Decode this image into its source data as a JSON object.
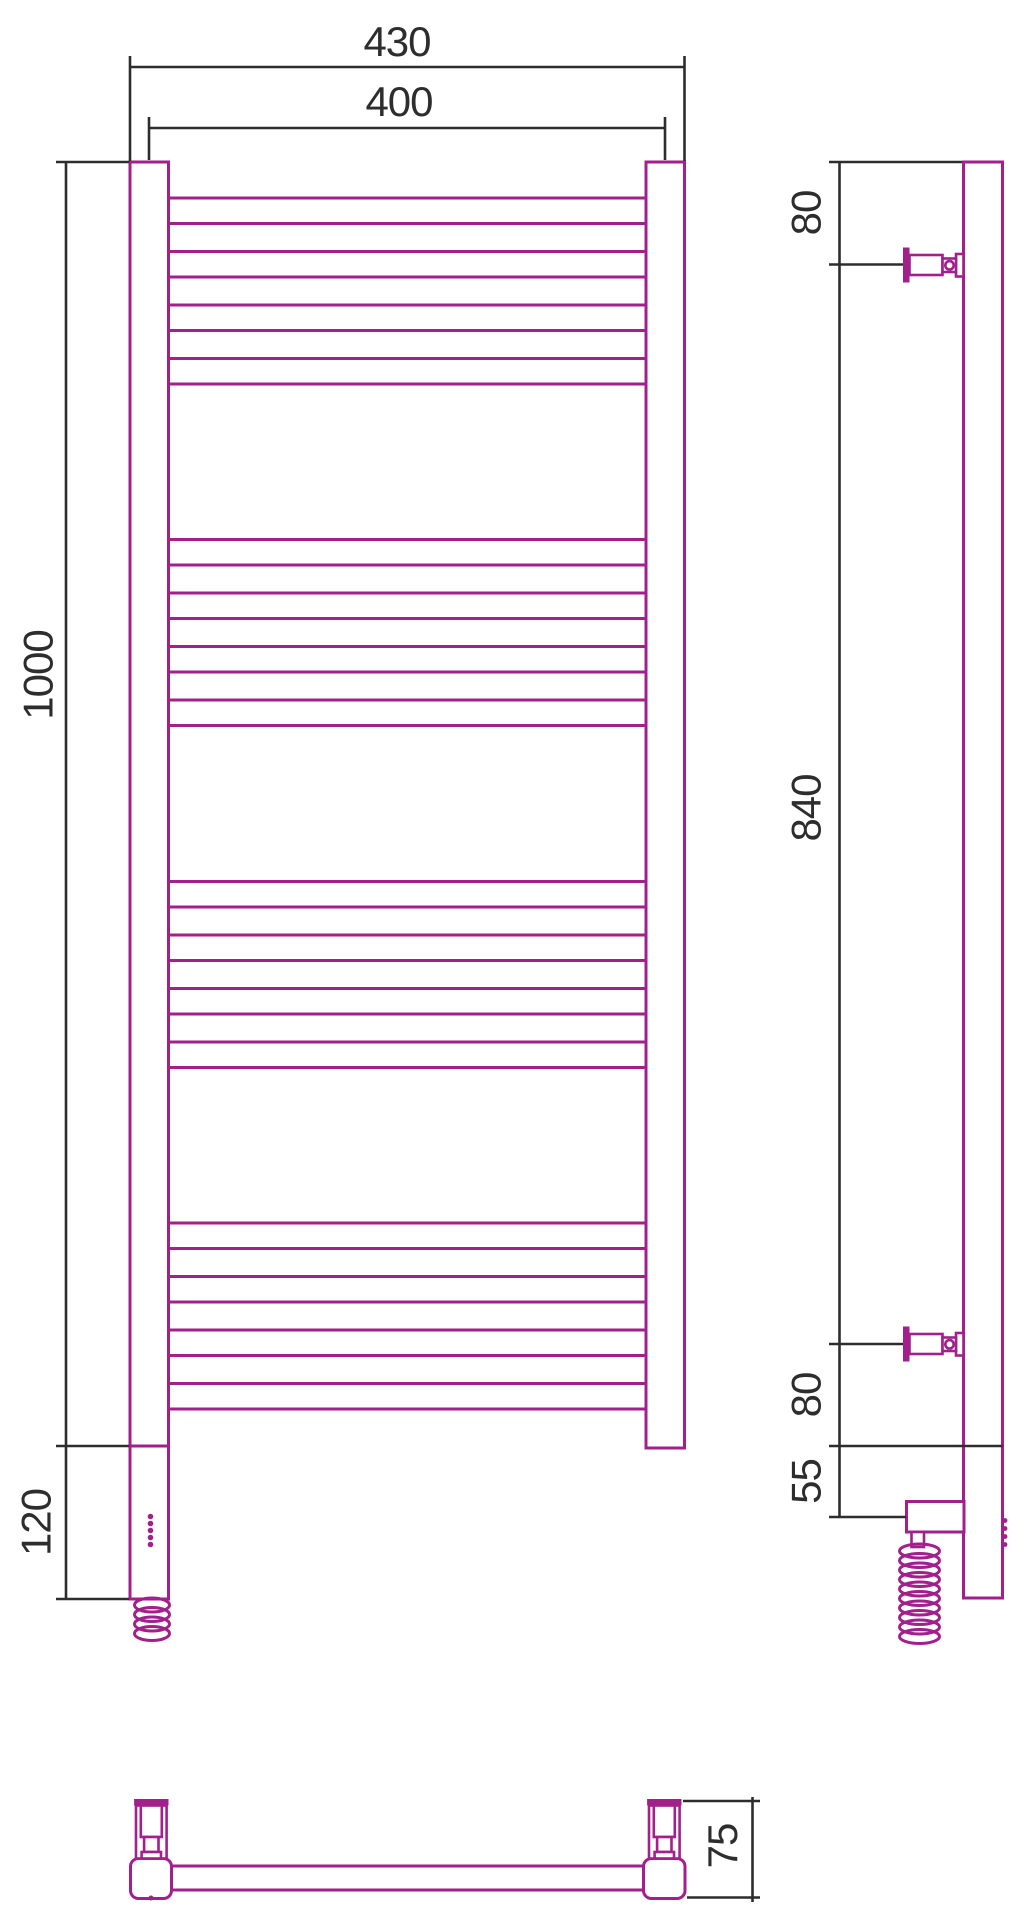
{
  "drawing": {
    "subject": "Electric heated towel rail — dimensional drawing, three views",
    "colors": {
      "product_outline": "#a2208c",
      "dimension_lines": "#2d2d2d",
      "background": "#ffffff"
    },
    "front": {
      "dim_width_overall": "430",
      "dim_width_centers": "400",
      "dim_height": "1000",
      "dim_heater_section": "120",
      "rung_count": 16,
      "rung_tops": [
        198,
        251.5,
        305,
        358.5,
        539.5,
        593,
        646.5,
        700,
        881.5,
        935,
        988.5,
        1042,
        1223,
        1276.5,
        1330,
        1383.5
      ],
      "rung_height": 25.5,
      "rung_x": 168.5,
      "rung_width": 477.5,
      "led_dot_x": 150.5,
      "led_dot_r": 2.8,
      "led_dot_ys": [
        1516.5,
        1523.5,
        1530.5,
        1537.5,
        1544.5
      ],
      "coil": {
        "cx": 152,
        "cy_start": 1605,
        "spacing": 9.5,
        "rings": 4,
        "rx": 17.5,
        "ry": 7
      }
    },
    "side": {
      "dim_top_bracket": "80",
      "dim_bracket_span": "840",
      "dim_bottom_bracket": "80",
      "dim_heater_offset": "55",
      "coil": {
        "cx": 919.5,
        "cy_start": 1551,
        "spacing": 9.5,
        "rings": 10,
        "rx": 20,
        "ry": 7
      },
      "nub_x": 1005,
      "nub_r": 2.4,
      "nub_ys": [
        1520.5,
        1528.5,
        1536.5,
        1544.5
      ]
    },
    "bottom": {
      "dim_depth": "75"
    }
  }
}
